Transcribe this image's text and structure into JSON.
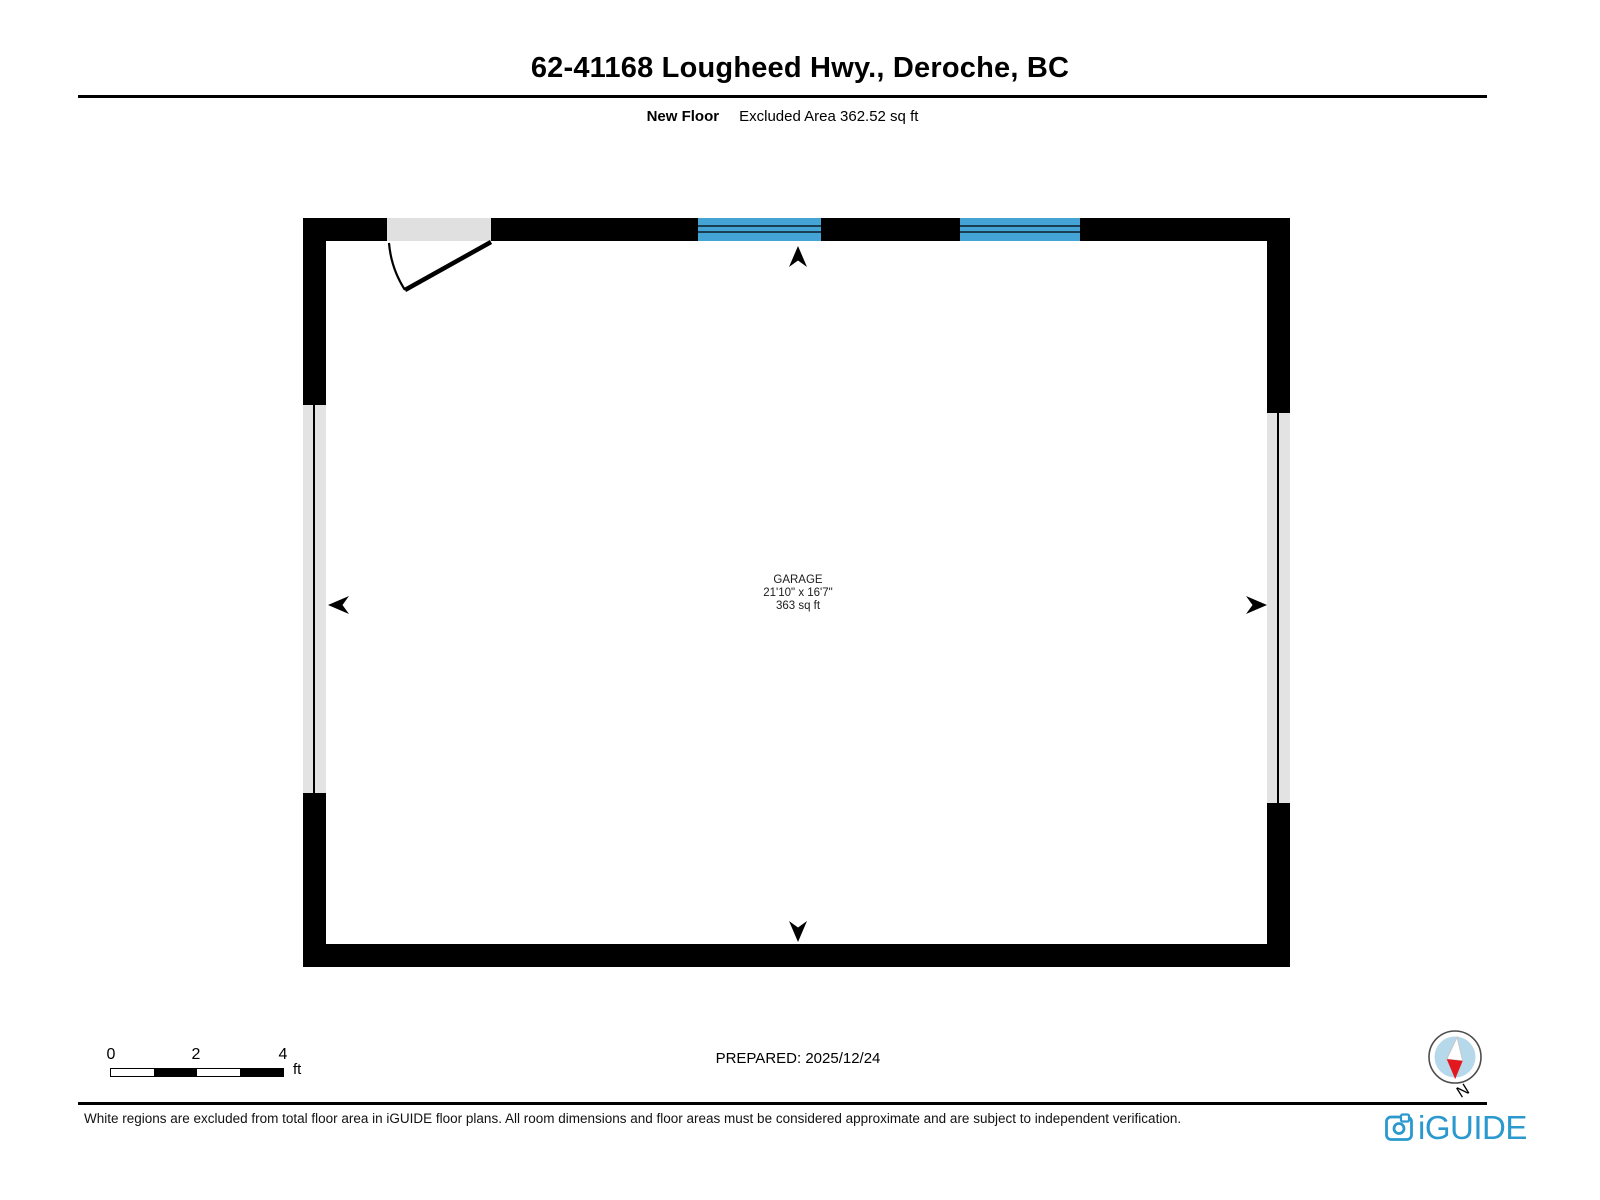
{
  "header": {
    "title": "62-41168 Lougheed Hwy., Deroche, BC",
    "floor_label": "New Floor",
    "excluded_area": "Excluded Area 362.52 sq ft"
  },
  "plan": {
    "room": {
      "name": "GARAGE",
      "dimensions": "21'10\" x 16'7\"",
      "area": "363 sq ft"
    },
    "colors": {
      "wall": "#000000",
      "window": "#45a4d6",
      "window_line": "#1a3e54",
      "excluded_fill": "#e0e0e0",
      "interior": "#ffffff"
    }
  },
  "footer": {
    "scale_bar": {
      "labels": [
        "0",
        "2",
        "4"
      ],
      "unit": "ft"
    },
    "prepared": "PREPARED: 2025/12/24",
    "compass": {
      "north_label": "N"
    },
    "disclaimer": "White regions are excluded from total floor area in iGUIDE floor plans. All room dimensions and floor areas must be considered approximate and are subject to independent verification.",
    "brand": {
      "name": "iGUIDE",
      "color": "#2b99ce"
    }
  }
}
